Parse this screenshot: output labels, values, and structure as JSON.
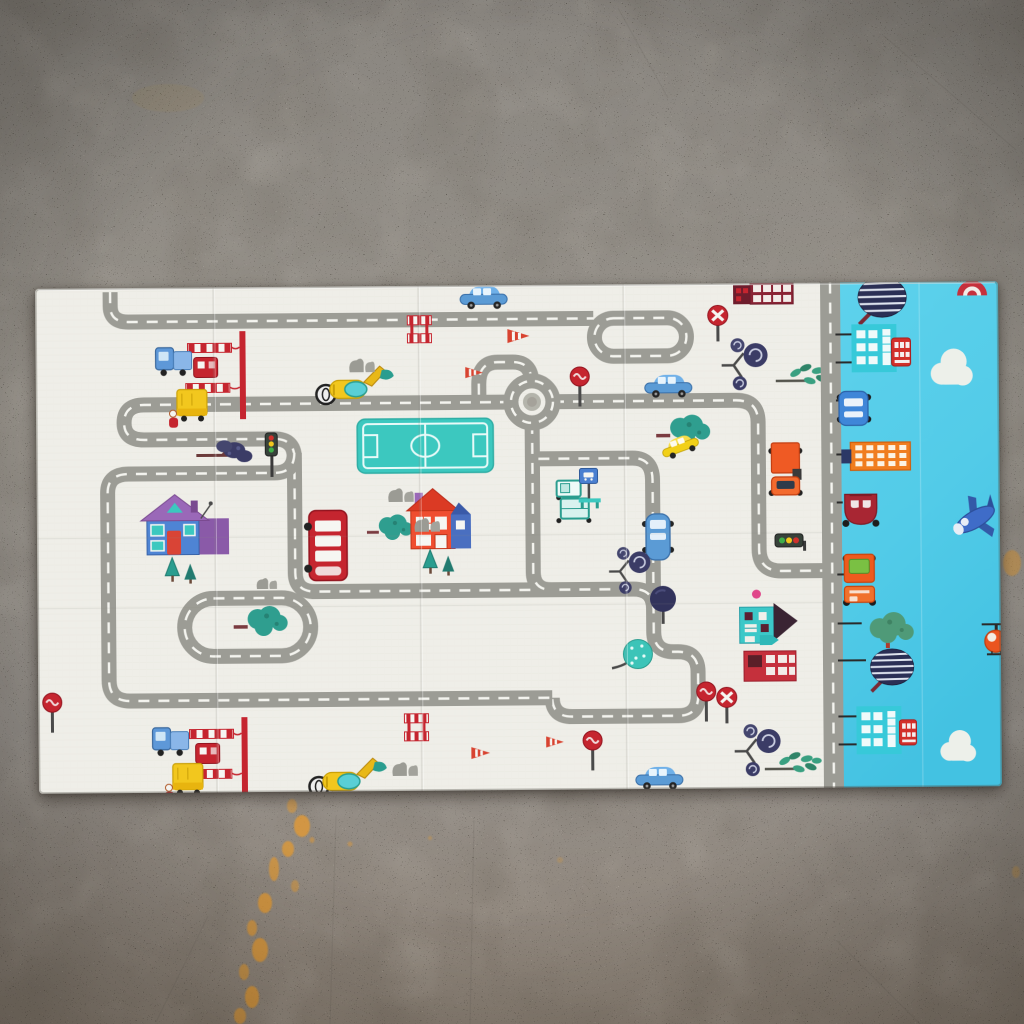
{
  "scene": {
    "subject": "foldable children's play mat with toy-town road map print lying on a concrete floor",
    "view": "top-down photo",
    "visible_text": ""
  },
  "palette": {
    "floor_top": "#8a8680",
    "floor_mid": "#98938b",
    "floor_bottom": "#8e8377",
    "stain": "#e29a33",
    "mat_white": "#efeee8",
    "mat_white_line": "#e3e2da",
    "mat_blue": "#58cde9",
    "mat_blue_deep": "#43c2e2",
    "road": "#9c9c95",
    "road_dash": "#f4f4ef",
    "road_island": "#b4b4ab",
    "road_width": 15,
    "dash_pattern": "11 9",
    "red": "#c5252f",
    "dark_red": "#8a2334",
    "orange": "#ee5a1e",
    "yellow": "#f2c71e",
    "teal": "#35c1b8",
    "navy": "#34355e",
    "green": "#4f9a78",
    "purple": "#9a68b8",
    "pink": "#e0478a"
  },
  "floor": {
    "stains": [
      [
        292,
        806,
        5,
        7,
        0.55
      ],
      [
        302,
        826,
        8,
        11,
        0.8
      ],
      [
        288,
        849,
        6,
        8,
        0.75
      ],
      [
        274,
        869,
        5,
        12,
        0.7
      ],
      [
        295,
        886,
        4,
        6,
        0.5
      ],
      [
        265,
        903,
        7,
        10,
        0.8
      ],
      [
        252,
        928,
        5,
        8,
        0.7
      ],
      [
        260,
        950,
        8,
        12,
        0.8
      ],
      [
        244,
        972,
        5,
        8,
        0.65
      ],
      [
        252,
        997,
        7,
        11,
        0.8
      ],
      [
        240,
        1016,
        6,
        8,
        0.7
      ],
      [
        312,
        840,
        2.5,
        3,
        0.5
      ],
      [
        350,
        844,
        2.5,
        2.5,
        0.45
      ],
      [
        430,
        838,
        2,
        2,
        0.35
      ],
      [
        1012,
        563,
        9,
        13,
        0.5
      ],
      [
        1016,
        872,
        4,
        6,
        0.3
      ],
      [
        168,
        98,
        36,
        14,
        0.06
      ],
      [
        560,
        860,
        3,
        3,
        0.25
      ]
    ],
    "seams": [
      [
        336,
        816,
        330,
        1024
      ],
      [
        474,
        820,
        470,
        1024
      ],
      [
        884,
        36,
        1016,
        150
      ],
      [
        618,
        8,
        668,
        98
      ],
      [
        156,
        1022,
        208,
        916
      ],
      [
        836,
        940,
        920,
        1024
      ]
    ]
  },
  "mat": {
    "x": 37,
    "y": 285,
    "width": 963,
    "height": 505,
    "rotation_deg": -0.45,
    "white_section": {
      "width": 785,
      "creases_v": [
        178,
        383,
        588
      ],
      "creases_h": [
        250,
        320
      ],
      "roundabout": {
        "cx": 496,
        "cy": 117,
        "r": 21,
        "island_r": 9
      },
      "roads": [
        "M 75 4 L 75 18 Q 75 34 93 34 L 558 34",
        "M 578 34 L 632 34 A 19 19 0 1 1 632 72 L 578 72 A 19 19 0 1 1 578 34 Z",
        "M 496 98 Q 496 77 477 77 L 462 77 Q 443 77 443 99 L 443 117",
        "M 475 117 L 108 117 Q 88 117 88 135 Q 88 152 108 152 L 238 152 Q 258 152 258 171 L 258 286 Q 258 305 278 305 L 596 305 Q 616 305 616 325 L 616 348 Q 616 368 636 368 L 640 368 Q 660 368 660 388 L 660 412 Q 660 432 640 432 L 534 432 Q 514 432 514 413",
        "M 258 166 Q 258 186 238 186 L 92 186 Q 71 186 71 205 L 71 392 Q 71 413 92 413 L 514 413",
        "M 176 311 L 244 311 A 29 29 0 1 1 244 369 L 176 369 A 29 29 0 1 1 176 311 Z",
        "M 517 117 L 700 117 Q 722 117 722 139 L 722 266 Q 722 288 744 288 L 785 288",
        "M 496 138 L 496 287 Q 496 305 514 305",
        "M 502 174 L 596 174 Q 616 174 616 196 L 616 305"
      ],
      "items": [
        {
          "t": "crossing",
          "x": 146,
          "y": 44
        },
        {
          "t": "truck-blue",
          "x": 118,
          "y": 56
        },
        {
          "t": "truck-yellow",
          "x": 131,
          "y": 100
        },
        {
          "t": "tree-branch-navy",
          "x": 158,
          "y": 150
        },
        {
          "t": "traffic-light-v",
          "x": 226,
          "y": 146
        },
        {
          "t": "excavator",
          "x": 278,
          "y": 76
        },
        {
          "t": "bush-gray",
          "x": 312,
          "y": 66
        },
        {
          "t": "field",
          "x": 321,
          "y": 133
        },
        {
          "t": "cone",
          "x": 470,
          "y": 42
        },
        {
          "t": "cone",
          "x": 428,
          "y": 80,
          "s": 0.8
        },
        {
          "t": "barrier",
          "x": 372,
          "y": 28
        },
        {
          "t": "car-blue",
          "x": 424,
          "y": 0
        },
        {
          "t": "sign-lollipop",
          "x": 532,
          "y": 82
        },
        {
          "t": "building-darkred",
          "x": 698,
          "y": -1
        },
        {
          "t": "sign-noentry",
          "x": 670,
          "y": 22
        },
        {
          "t": "tree-spiral",
          "x": 684,
          "y": 54
        },
        {
          "t": "car-blue",
          "x": 608,
          "y": 90
        },
        {
          "t": "tree-leaf-green",
          "x": 740,
          "y": 80
        },
        {
          "t": "tree-cloud-teal",
          "x": 620,
          "y": 128
        },
        {
          "t": "car-yellow-v",
          "x": 622,
          "y": 160,
          "r": -20,
          "s": 0.8
        },
        {
          "t": "truck-orange-v",
          "x": 730,
          "y": 158
        },
        {
          "t": "house-purple",
          "x": 104,
          "y": 203
        },
        {
          "t": "pines",
          "x": 126,
          "y": 268
        },
        {
          "t": "bus-red",
          "x": 266,
          "y": 222
        },
        {
          "t": "tree-cloud-teal",
          "x": 330,
          "y": 226,
          "s": 0.85
        },
        {
          "t": "house-red",
          "x": 370,
          "y": 201
        },
        {
          "t": "pines",
          "x": 384,
          "y": 262
        },
        {
          "t": "bush-gray",
          "x": 350,
          "y": 196
        },
        {
          "t": "bush-gray",
          "x": 376,
          "y": 226
        },
        {
          "t": "bush-gray",
          "x": 218,
          "y": 286,
          "s": 0.8
        },
        {
          "t": "truck-teal",
          "x": 514,
          "y": 192
        },
        {
          "t": "busstop",
          "x": 540,
          "y": 184
        },
        {
          "t": "van-blue-v",
          "x": 604,
          "y": 228
        },
        {
          "t": "traffic-light-h",
          "x": 738,
          "y": 248
        },
        {
          "t": "tree-spiral",
          "x": 570,
          "y": 262,
          "s": 0.9
        },
        {
          "t": "tree-ball-navy",
          "x": 608,
          "y": 300
        },
        {
          "t": "dot-pink",
          "x": 714,
          "y": 306
        },
        {
          "t": "tree-ball-teal",
          "x": 572,
          "y": 352
        },
        {
          "t": "tree-cloud-teal",
          "x": 196,
          "y": 316
        },
        {
          "t": "house-teal-red",
          "x": 700,
          "y": 320
        },
        {
          "t": "sign-lollipop",
          "x": 656,
          "y": 398
        },
        {
          "t": "sign-noentry",
          "x": 676,
          "y": 404
        },
        {
          "t": "tree-spiral",
          "x": 694,
          "y": 440
        },
        {
          "t": "tree-leaf-green",
          "x": 726,
          "y": 468
        },
        {
          "t": "car-blue",
          "x": 596,
          "y": 482
        },
        {
          "t": "crossing",
          "x": 145,
          "y": 430
        },
        {
          "t": "truck-blue",
          "x": 112,
          "y": 436
        },
        {
          "t": "truck-yellow",
          "x": 124,
          "y": 474
        },
        {
          "t": "excavator",
          "x": 268,
          "y": 468
        },
        {
          "t": "bush-gray",
          "x": 352,
          "y": 470
        },
        {
          "t": "barrier",
          "x": 366,
          "y": 426
        },
        {
          "t": "cone",
          "x": 431,
          "y": 460,
          "s": 0.85
        },
        {
          "t": "cone",
          "x": 506,
          "y": 450,
          "s": 0.8
        },
        {
          "t": "sign-lollipop",
          "x": 542,
          "y": 446
        },
        {
          "t": "sign-lollipop",
          "x": 2,
          "y": 404
        }
      ]
    },
    "divider_road": {
      "cx": 795,
      "width": 20
    },
    "blue_section": {
      "x": 805,
      "width": 158,
      "creases_v": [
        884
      ],
      "poles": [
        [
          800,
          52,
          818,
          52
        ],
        [
          800,
          80,
          818,
          80
        ],
        [
          800,
          118,
          806,
          118
        ],
        [
          800,
          172,
          808,
          172
        ],
        [
          800,
          220,
          806,
          220
        ],
        [
          800,
          292,
          807,
          292
        ],
        [
          800,
          341,
          824,
          341
        ],
        [
          800,
          378,
          828,
          378
        ],
        [
          800,
          434,
          820,
          434
        ],
        [
          800,
          462,
          820,
          462
        ]
      ],
      "items": [
        {
          "t": "btree-striped",
          "x": 818,
          "y": -6
        },
        {
          "t": "red-arc",
          "x": 920,
          "y": -2
        },
        {
          "t": "bbuilding-teal",
          "x": 816,
          "y": 42
        },
        {
          "t": "bbus-red",
          "x": 855,
          "y": 54
        },
        {
          "t": "cloud",
          "x": 893,
          "y": 64
        },
        {
          "t": "bcar-blue",
          "x": 801,
          "y": 106
        },
        {
          "t": "bbuilding-orange",
          "x": 805,
          "y": 158
        },
        {
          "t": "bcar-darkred",
          "x": 803,
          "y": 204
        },
        {
          "t": "plane",
          "x": 910,
          "y": 210
        },
        {
          "t": "btruck-orange",
          "x": 804,
          "y": 270
        },
        {
          "t": "btree-green",
          "x": 822,
          "y": 328
        },
        {
          "t": "heli",
          "x": 944,
          "y": 338
        },
        {
          "t": "btree-striped",
          "x": 828,
          "y": 366,
          "s": 0.9
        },
        {
          "t": "bbuilding-teal",
          "x": 818,
          "y": 424
        },
        {
          "t": "bbus-red",
          "x": 860,
          "y": 436,
          "s": 0.9
        },
        {
          "t": "cloud",
          "x": 900,
          "y": 446,
          "s": 0.85
        }
      ]
    }
  }
}
